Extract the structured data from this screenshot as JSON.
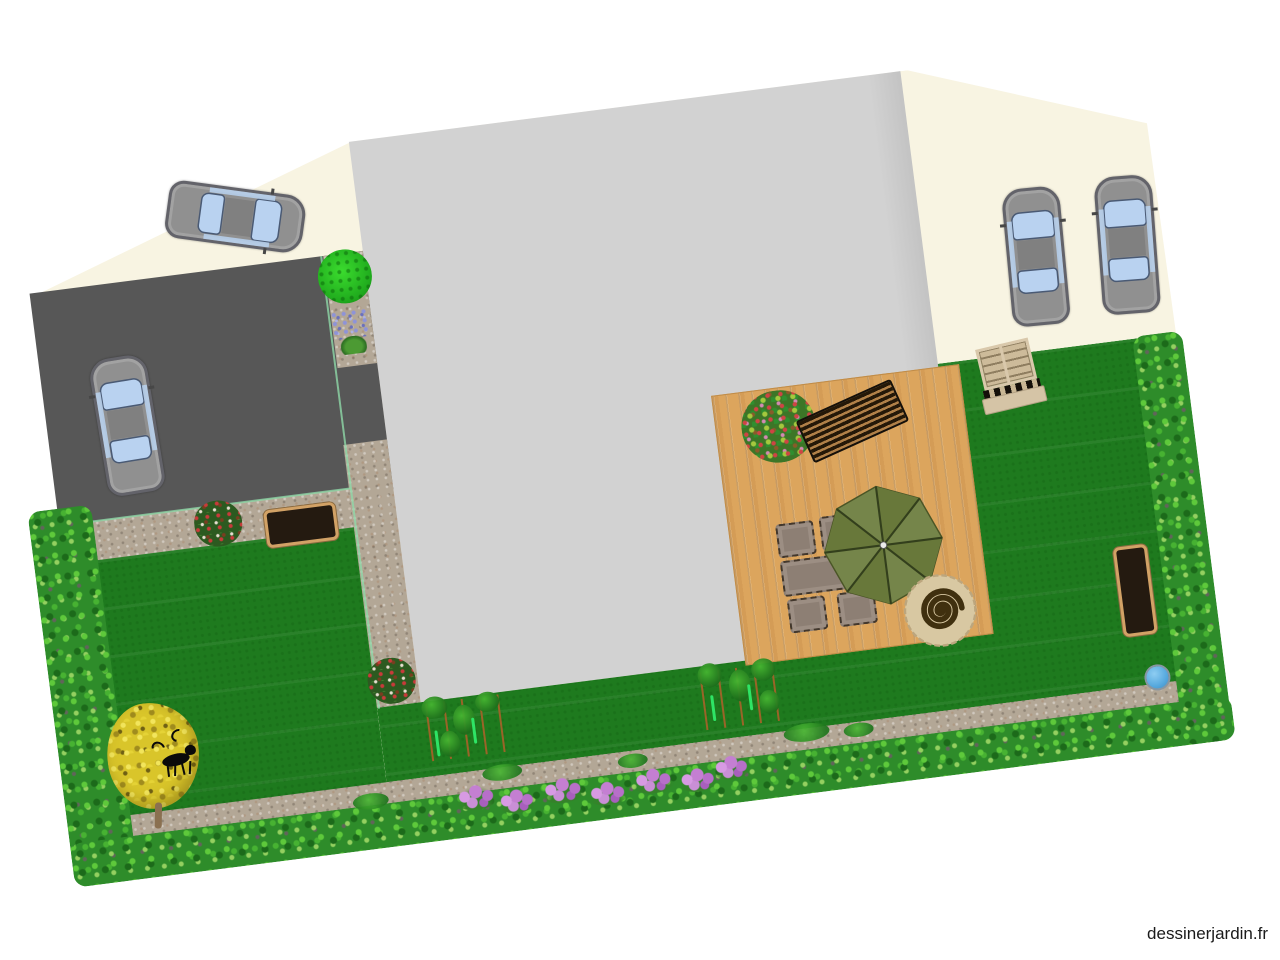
{
  "watermark": {
    "text": "dessinerjardin.fr"
  },
  "scene": {
    "type": "garden-plan-top-view",
    "rotation_deg": -7.3,
    "colors": {
      "cream": "#f8f4e2",
      "house": "#d2d2d2",
      "parking": "#575757",
      "gravel": "#b3a796",
      "lawn": "#1e7a1e",
      "hedge": "#2e8c2a",
      "deck": "#dca55d",
      "parasol": "#6f7f3d",
      "furniture": "#8d7f74",
      "furniture-border": "#42372c",
      "planter-fill": "#241a10",
      "planter-border": "#d2a266",
      "car-body": "#909090",
      "car-window": "#b9d2f0",
      "ball": "#57a9de",
      "flower": "#c47fd2",
      "tree-yellow": "#d9c52a",
      "bench-tan": "#d9c8ab",
      "spiral": "#40300f",
      "edging": "#8fd8a8"
    },
    "inventory": {
      "house_footprint": 1,
      "cream_courtyard": 1,
      "parking_area": 1,
      "gravel_paths": 4,
      "lawns": 2,
      "wooden_deck": 1,
      "hedges": [
        "left",
        "bottom",
        "right"
      ],
      "cars": 4,
      "parasol": 1,
      "armchairs": 4,
      "patio_table": 1,
      "sun_lounger": 1,
      "garden_bench": 1,
      "planter_boxes": 2,
      "spiral_ornament": 1,
      "blue_ball": 1,
      "round_shrub": 1,
      "rose_bushes": 2,
      "iris_patch": 1,
      "grass_tuft": 1,
      "deck_tree": 1,
      "yellow_tree": 1,
      "dog_figure": 1,
      "vine_trellises": 2,
      "flower_clusters": 7
    }
  }
}
